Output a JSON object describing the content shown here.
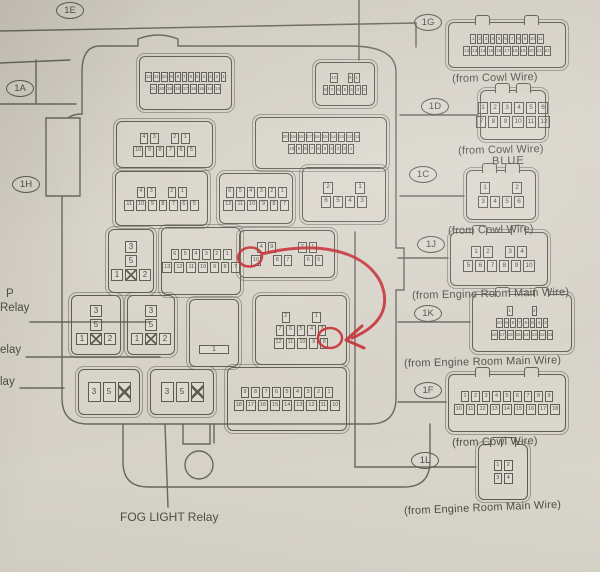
{
  "palette": {
    "paper": "#d6d2c8",
    "ink": "#5d5a51",
    "text": "#4f4c45",
    "red": "#c3272c"
  },
  "ovals": {
    "e": "1E",
    "a": "1A",
    "h": "1H",
    "g": "1G",
    "d": "1D",
    "c": "1C",
    "j": "1J",
    "k": "1K",
    "f": "1F",
    "l": "1L"
  },
  "edge_labels": {
    "line1": "P",
    "line2": "Relay",
    "line3": "elay",
    "line4": "lay"
  },
  "misc": {
    "fog": "FOG LIGHT Relay",
    "blue": "BLUE"
  },
  "captions": {
    "cowl": "(from Cowl Wire)",
    "engine": "(from Engine Room Main Wire)"
  },
  "pins": {
    "box_a": [
      [
        "12",
        "11",
        "10",
        "9",
        "8",
        "7",
        "6",
        "5",
        "4",
        "3",
        "2",
        "1"
      ],
      [
        "21",
        "20",
        "19",
        "18",
        "17",
        "16",
        "15",
        "14",
        "13"
      ]
    ],
    "box_b": [
      [
        "10",
        "",
        "9",
        "1"
      ],
      [
        "8",
        "7",
        "6",
        "5",
        "4",
        "3",
        "2"
      ]
    ],
    "box_c": [
      [
        "4",
        "3",
        "",
        "2",
        "1"
      ],
      [
        "10",
        "9",
        "8",
        "7",
        "6",
        "5"
      ]
    ],
    "box_d": [
      [
        "20",
        "19",
        "18",
        "17",
        "16",
        "15",
        "14",
        "13",
        "12",
        "11"
      ],
      [
        "10",
        "9",
        "8",
        "7",
        "6",
        "5",
        "4",
        "3",
        "2",
        "1"
      ]
    ],
    "box_e": [
      [
        "4",
        "3",
        "",
        "2",
        "1"
      ],
      [
        "11",
        "10",
        "9",
        "8",
        "7",
        "6",
        "5"
      ]
    ],
    "box_f": [
      [
        "6",
        "5",
        "4",
        "3",
        "2",
        "1"
      ],
      [
        "12",
        "11",
        "10",
        "9",
        "8",
        "7"
      ]
    ],
    "box_g": [
      [
        "2",
        "",
        "",
        "1"
      ],
      [
        "6",
        "5",
        "4",
        "3"
      ]
    ],
    "box_i": [
      [
        "6",
        "5",
        "4",
        "3",
        "2",
        "1"
      ],
      [
        "13",
        "12",
        "11",
        "10",
        "9",
        "8",
        "7"
      ]
    ],
    "box_j": [
      [
        "4",
        "9",
        "",
        "",
        "2",
        "1"
      ],
      [
        "10",
        "",
        "8",
        "7",
        "",
        "6",
        "5"
      ]
    ],
    "box_n": [
      [
        "2",
        "",
        "",
        "1"
      ],
      [
        "7",
        "6",
        "5",
        "4",
        "3"
      ],
      [
        "12",
        "11",
        "10",
        "9",
        "8"
      ]
    ],
    "box_q": [
      [
        "9",
        "8",
        "7",
        "6",
        "5",
        "4",
        "3",
        "2",
        "1"
      ],
      [
        "18",
        "17",
        "16",
        "15",
        "14",
        "13",
        "12",
        "11",
        "10"
      ]
    ],
    "relay_v": [
      [
        "3"
      ],
      [
        "5"
      ],
      [
        "1",
        "X",
        "2"
      ]
    ],
    "relay_h": [
      [
        "3",
        "5",
        "X"
      ]
    ],
    "relay_big": [
      [
        "1"
      ]
    ],
    "c1g": [
      [
        "1",
        "2",
        "3",
        "4",
        "5",
        "6",
        "7",
        "8",
        "9",
        "10",
        "11"
      ],
      [
        "12",
        "13",
        "14",
        "15",
        "16",
        "17",
        "18",
        "19",
        "20",
        "21",
        "22"
      ]
    ],
    "c1d": [
      [
        "1",
        "2",
        "3",
        "4",
        "5",
        "6"
      ],
      [
        "7",
        "8",
        "9",
        "10",
        "11",
        "12"
      ]
    ],
    "c1c": [
      [
        "1",
        "",
        "",
        "2"
      ],
      [
        "3",
        "4",
        "5",
        "6"
      ]
    ],
    "c1j": [
      [
        "1",
        "2",
        "",
        "3",
        "4"
      ],
      [
        "5",
        "6",
        "7",
        "8",
        "9",
        "10"
      ]
    ],
    "c1k": [
      [
        "1",
        "",
        "",
        "2"
      ],
      [
        "10",
        "9",
        "8",
        "7",
        "6",
        "5",
        "4",
        "3"
      ],
      [
        "18",
        "17",
        "16",
        "15",
        "14",
        "13",
        "12",
        "11"
      ]
    ],
    "c1f": [
      [
        "1",
        "2",
        "3",
        "4",
        "5",
        "6",
        "7",
        "8",
        "9"
      ],
      [
        "10",
        "11",
        "12",
        "13",
        "14",
        "15",
        "16",
        "17",
        "18"
      ]
    ],
    "c1l": [
      [
        "1",
        "2"
      ],
      [
        "3",
        "4"
      ]
    ]
  }
}
